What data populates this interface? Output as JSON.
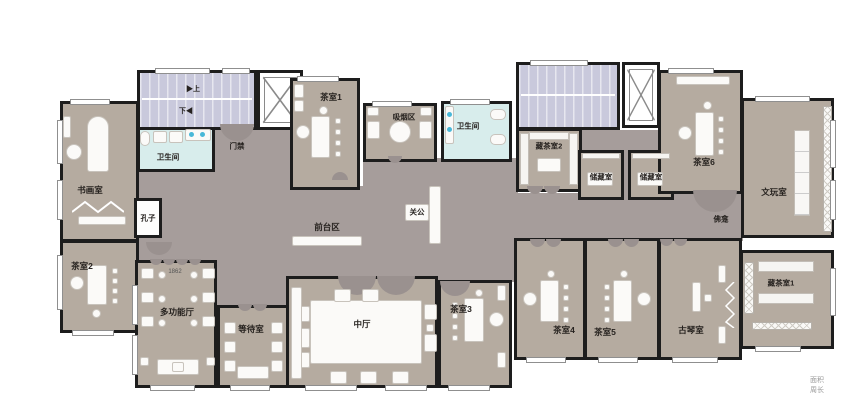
{
  "floorplan": {
    "rooms": [
      "书画室",
      "茶室2",
      "卫生间",
      "多功能厅",
      "等待室",
      "茶室1",
      "吸烟区",
      "卫生间",
      "中厅",
      "茶室3",
      "藏茶室2",
      "储藏室",
      "储藏室",
      "茶室6",
      "文玩室",
      "茶室4",
      "茶室5",
      "古琴室",
      "藏茶室1"
    ],
    "corridor": {
      "reception": "前台区",
      "access_control": "门禁",
      "confucius_niche": "孔子",
      "guangong_altar": "关公",
      "shrine": "佛龛"
    },
    "stairs": {
      "up": "▶上",
      "down": "下◀"
    },
    "annotations": {
      "dimension": "1862"
    },
    "footer": {
      "area": "面积",
      "perimeter": "周长"
    },
    "colors": {
      "wall": "#1d1d1d",
      "room_fill": "#b5aba0",
      "corridor_fill": "#a69d9b",
      "stair_fill": "#c9c9dc",
      "bathroom_fill": "#d8edec",
      "fixture_accent": "#49b8d8"
    }
  }
}
